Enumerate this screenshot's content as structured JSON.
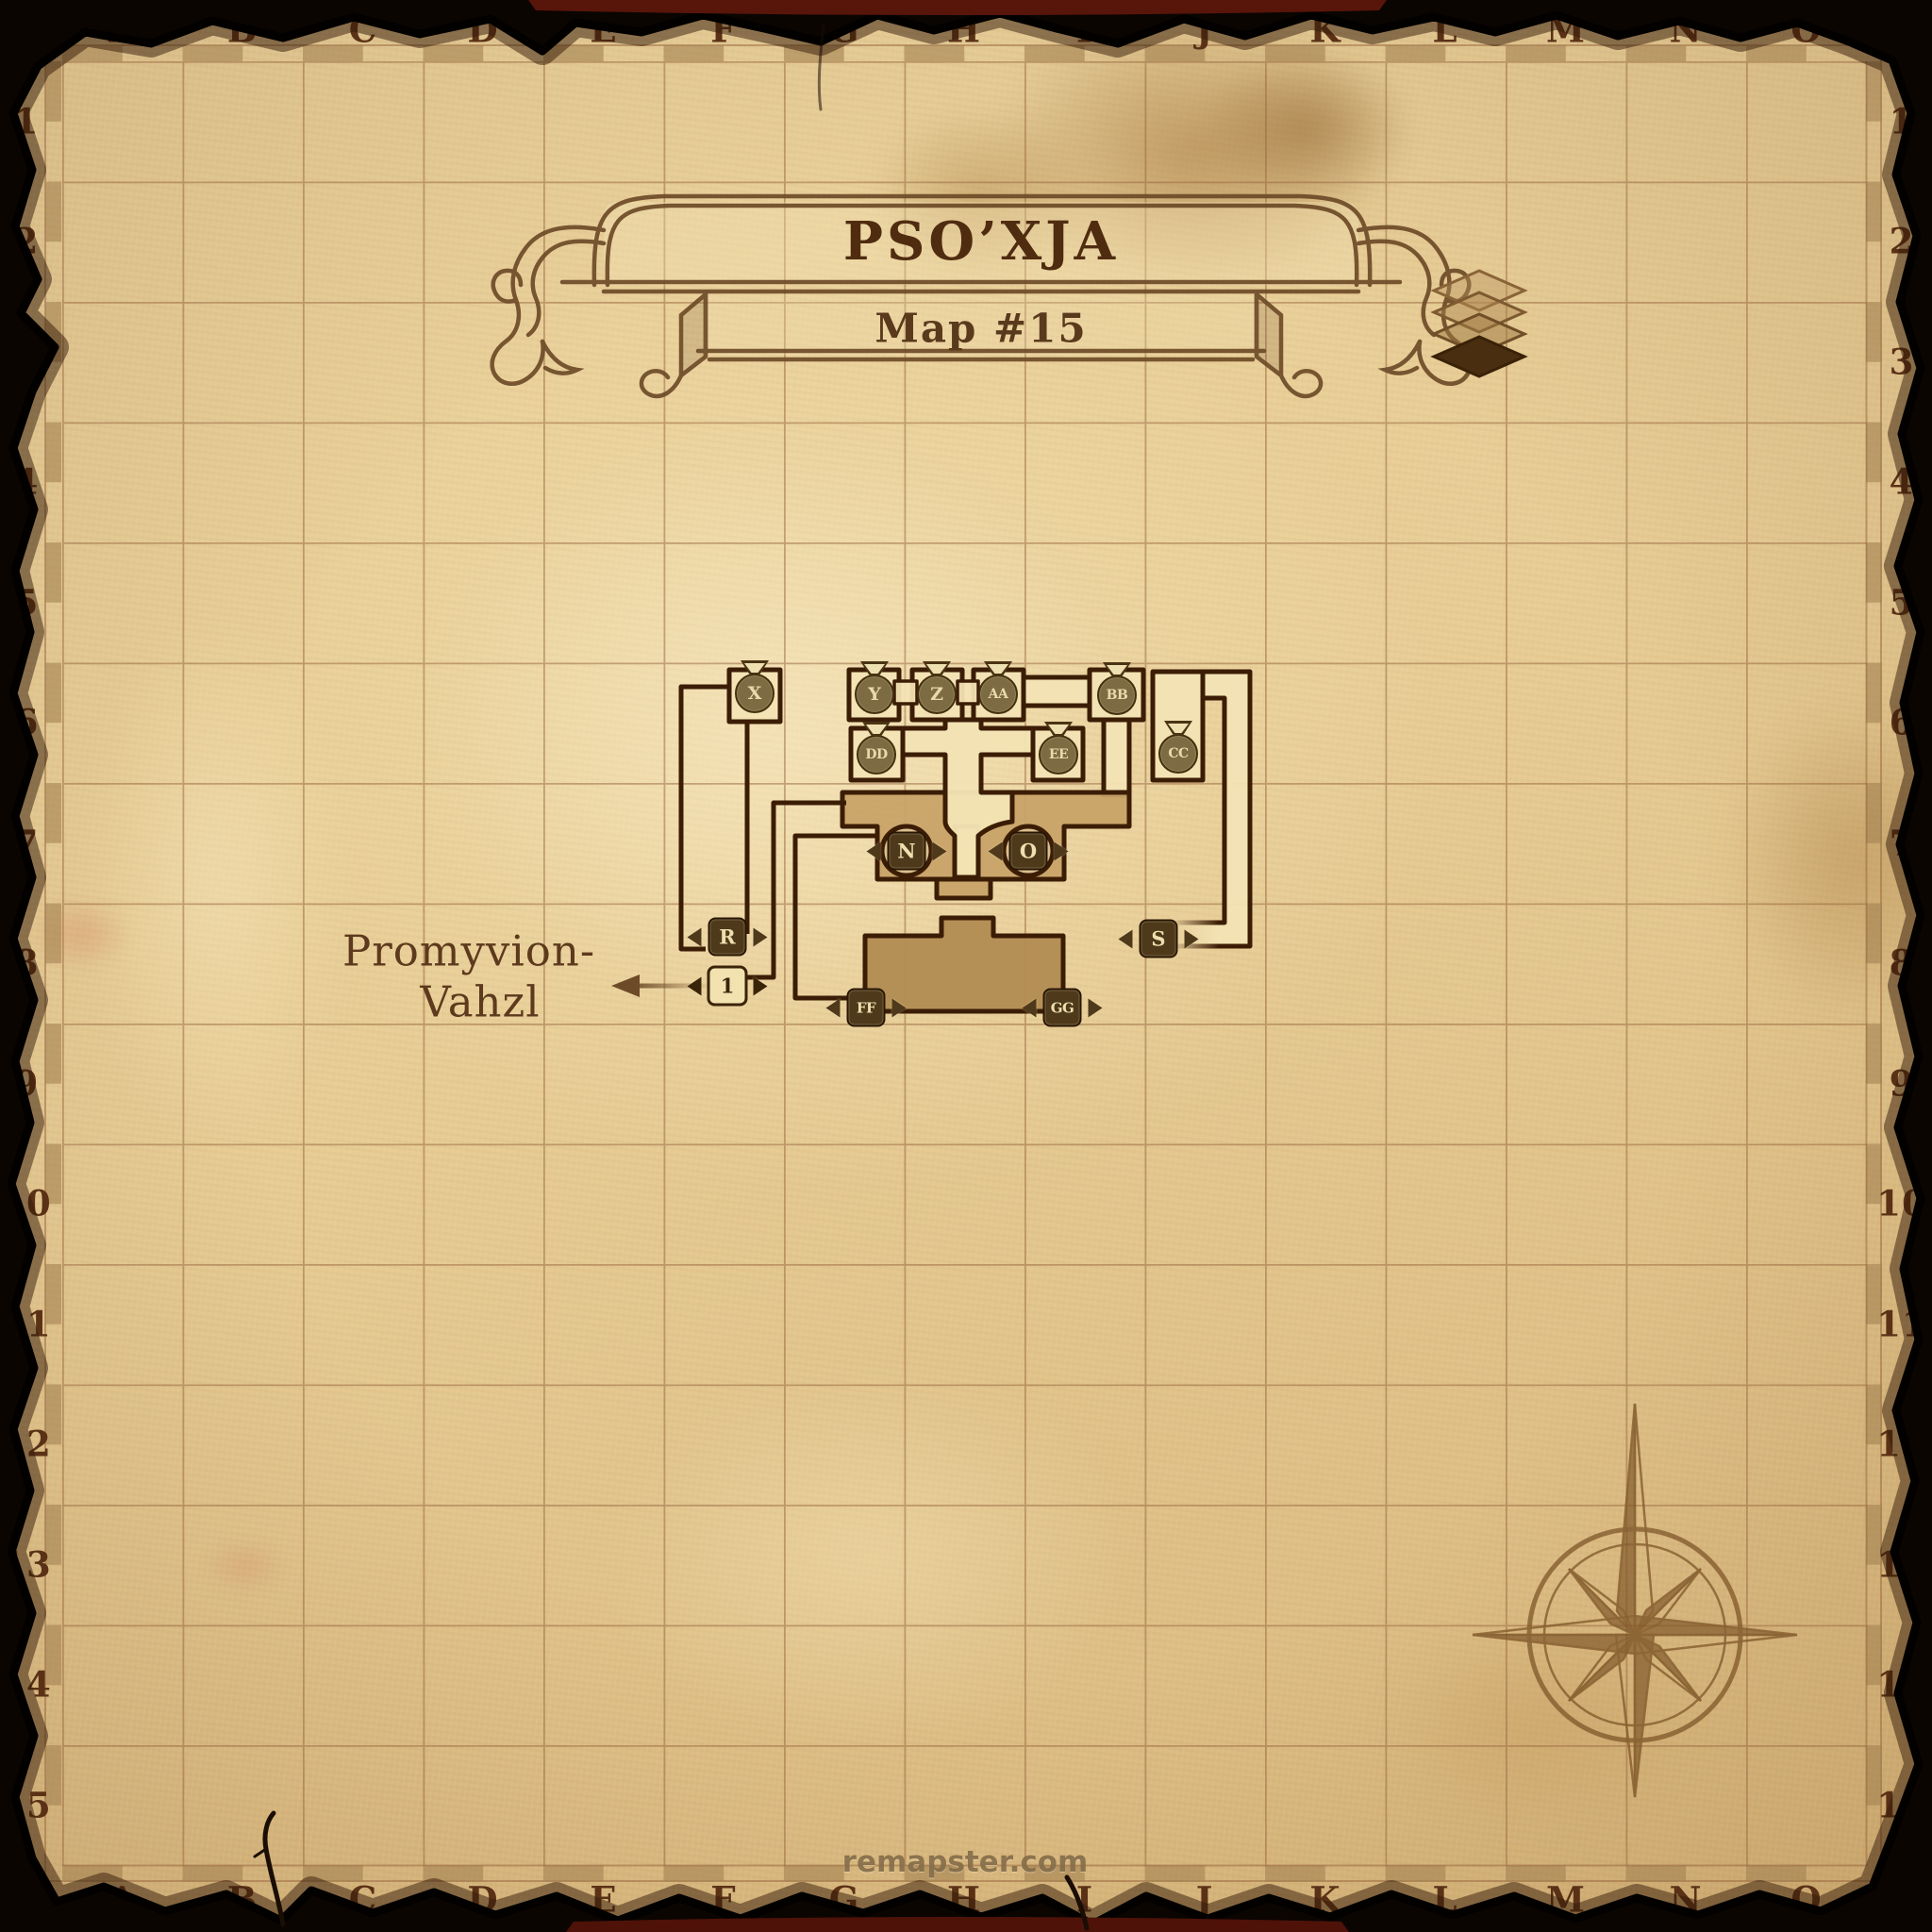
{
  "map": {
    "title": "PSO’XJA",
    "subtitle": "Map #15"
  },
  "grid": {
    "columns": [
      "A",
      "B",
      "C",
      "D",
      "E",
      "F",
      "G",
      "H",
      "I",
      "J",
      "K",
      "L",
      "M",
      "N",
      "O"
    ],
    "rows": [
      "1",
      "2",
      "3",
      "4",
      "5",
      "6",
      "7",
      "8",
      "9",
      "10",
      "11",
      "12",
      "13",
      "14",
      "15"
    ]
  },
  "markers": {
    "poi": [
      {
        "id": "X"
      },
      {
        "id": "Y"
      },
      {
        "id": "Z"
      },
      {
        "id": "AA"
      },
      {
        "id": "BB"
      },
      {
        "id": "DD"
      },
      {
        "id": "EE"
      },
      {
        "id": "CC"
      }
    ],
    "transit": [
      {
        "id": "N"
      },
      {
        "id": "O"
      },
      {
        "id": "R"
      },
      {
        "id": "S"
      },
      {
        "id": "FF"
      },
      {
        "id": "GG"
      }
    ],
    "zone_exit": [
      {
        "id": "1",
        "destination": "Promyvion-Vahzl"
      }
    ]
  },
  "exit_label": {
    "line1": "Promyvion-",
    "line2": "Vahzl"
  },
  "watermark": "remapster.com",
  "icons": {
    "floors": "layers-icon",
    "compass": "compass-rose-icon"
  },
  "colors": {
    "parchment": "#e7cc96",
    "wall": "#3b1d06",
    "label": "#5a3116",
    "room_light": "#f2e2b2",
    "room_shaded": "#c8a368",
    "room_dark": "#b28c52",
    "marker_medallion": "#7d6b43",
    "marker_square": "#4e391b",
    "marker_exit_bg": "#f2e2b0",
    "burnt_edge": "#0b0502",
    "backing": "#58150a"
  }
}
